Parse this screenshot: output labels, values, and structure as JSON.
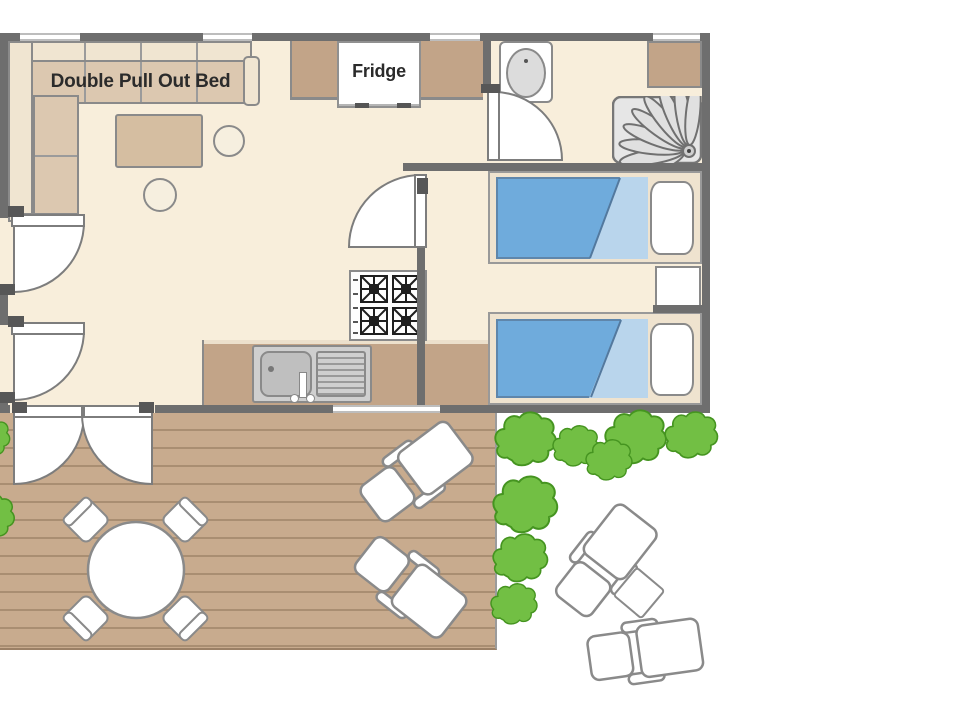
{
  "title": "Mobile home floor plan",
  "labels": {
    "sofa": "Double Pull Out Bed",
    "fridge": "Fridge"
  },
  "colors": {
    "background": "#ffffff",
    "wall": "#6e6e6e",
    "floor": "#f8eedb",
    "outline": "#8a8a8a",
    "counter": "#c2a488",
    "sofa_cushion": "#dcc8b0",
    "sofa_frame": "#f0e5d1",
    "table_wood": "#d5bea1",
    "bed_blanket": "#6fabdc",
    "bed_blanket_fold": "#b9d5ec",
    "bed_frame": "#efe3cf",
    "bed_edge": "#5f86ab",
    "deck": "#c8ab8e",
    "deck_line": "#a98e72",
    "bush": "#72bf44",
    "bush_outline": "#459420",
    "fixture_gray": "#d9d9d9",
    "text": "#2b2b2b"
  }
}
